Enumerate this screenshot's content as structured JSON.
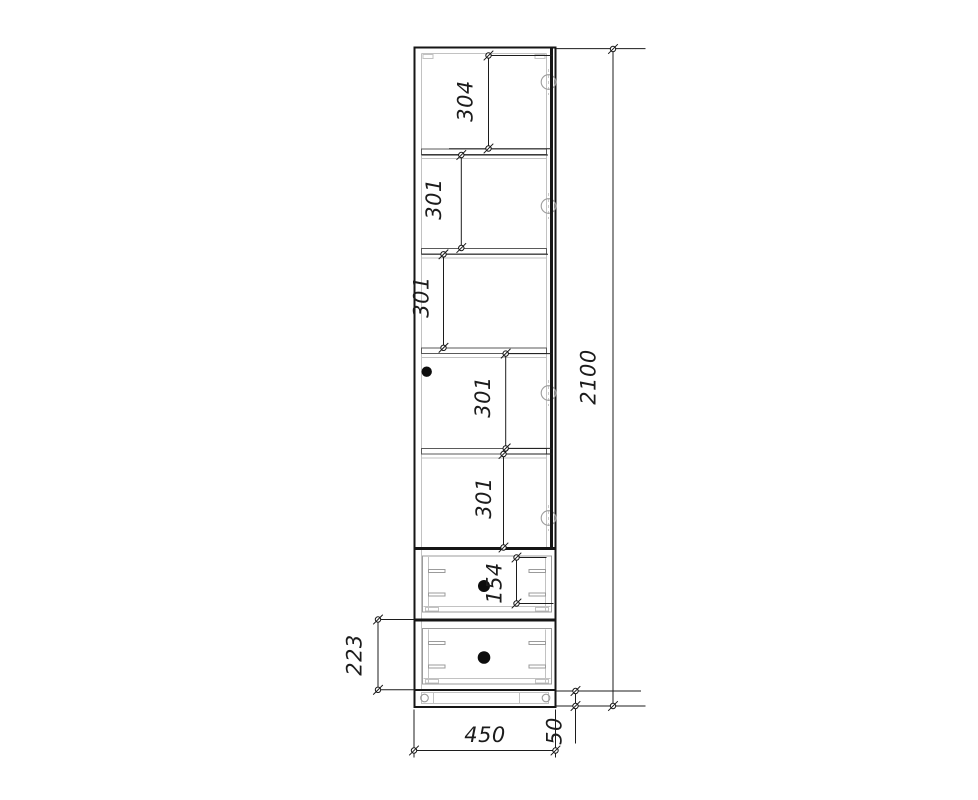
{
  "dimensions": {
    "overall_height": "2100",
    "overall_width": "450",
    "plinth_height": "50",
    "sections": [
      "304",
      "301",
      "301",
      "301",
      "301"
    ],
    "drawer_top_front": "154",
    "drawer_bottom_section": "223"
  },
  "colors": {
    "line": "#161616",
    "panel_gray": "#c2c2c2",
    "hardware_gray": "#9b9b9b",
    "background": "#ffffff"
  }
}
